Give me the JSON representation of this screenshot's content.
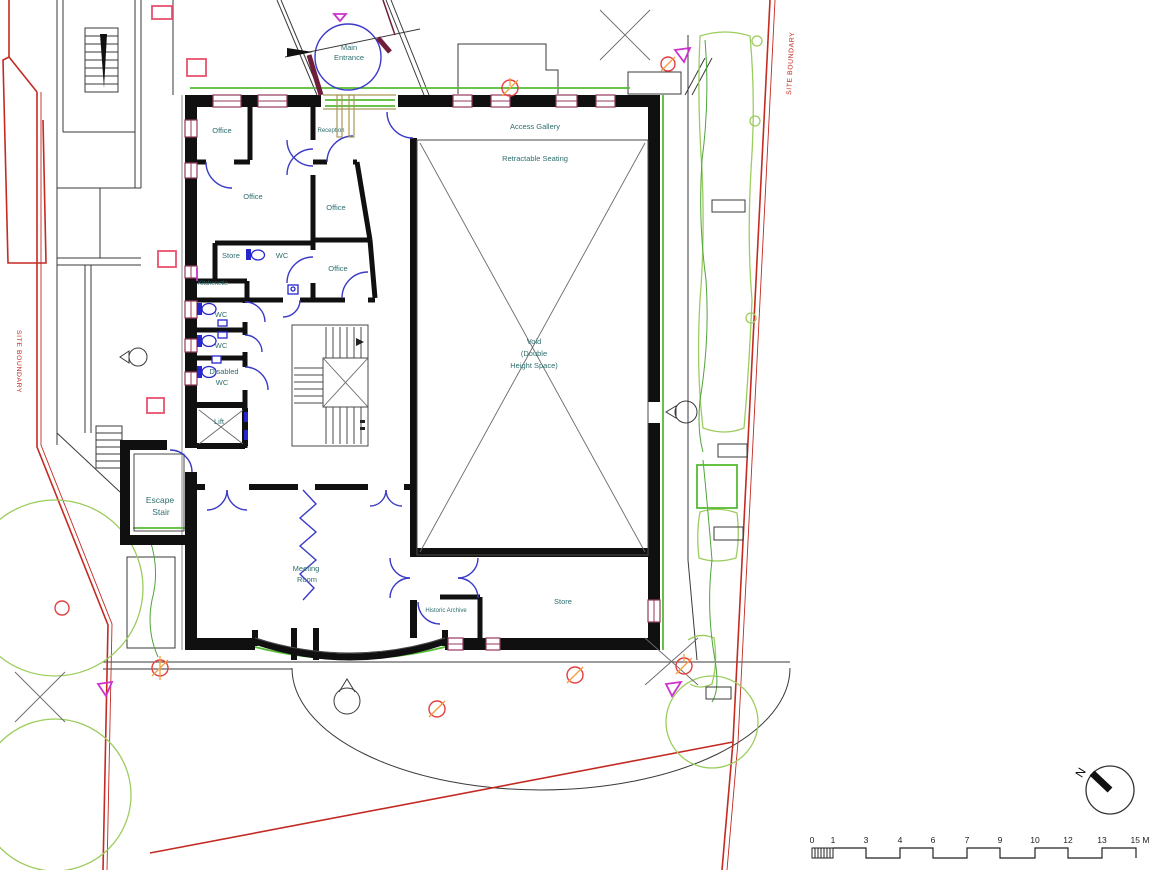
{
  "plan": {
    "rooms": {
      "office_nw": "Office",
      "reception": "Reception",
      "access_gallery": "Access Gallery",
      "retractable_seating": "Retractable Seating",
      "office_w": "Office",
      "office_mid": "Office",
      "store_small": "Store",
      "wc_upper": "WC",
      "office_s": "Office",
      "kitchenette": "Kitchenette",
      "wc_1": "WC",
      "wc_2": "WC",
      "disabled_wc": {
        "lines": [
          "Disabled",
          "WC"
        ]
      },
      "lift": "Lift",
      "void": {
        "lines": [
          "Void",
          "(Double",
          "Height Space)"
        ]
      },
      "escape_stair": {
        "lines": [
          "Escape",
          "Stair"
        ]
      },
      "meeting_room": {
        "lines": [
          "Meeting",
          "Room"
        ]
      },
      "historic_archive": "Historic Archive",
      "store_large": "Store",
      "main_entrance": {
        "lines": [
          "Main",
          "Entrance"
        ]
      }
    },
    "annotations": {
      "site_boundary_left": "SITE BOUNDARY",
      "site_boundary_right": "SITE BOUNDARY",
      "north_label": "N"
    },
    "scale_bar": {
      "labels": [
        "0",
        "1",
        "3",
        "4",
        "6",
        "7",
        "9",
        "10",
        "12",
        "13",
        "15 M"
      ],
      "unit": "M"
    },
    "colors": {
      "wall_black": "#101010",
      "label_teal": "#2e6e6e",
      "boundary_red": "#c32a22",
      "door_blue": "#3a3ac8",
      "landscape_green": "#55bb33",
      "tree_green": "#9ccc5e",
      "window_maroon": "#943a5e",
      "marker_magenta": "#cc33cc",
      "marker_pink": "#e8506e",
      "marker_orange": "#f59d3d",
      "entrance_maroon": "#6e1d3d",
      "glazing_tan": "#a89a55"
    }
  }
}
